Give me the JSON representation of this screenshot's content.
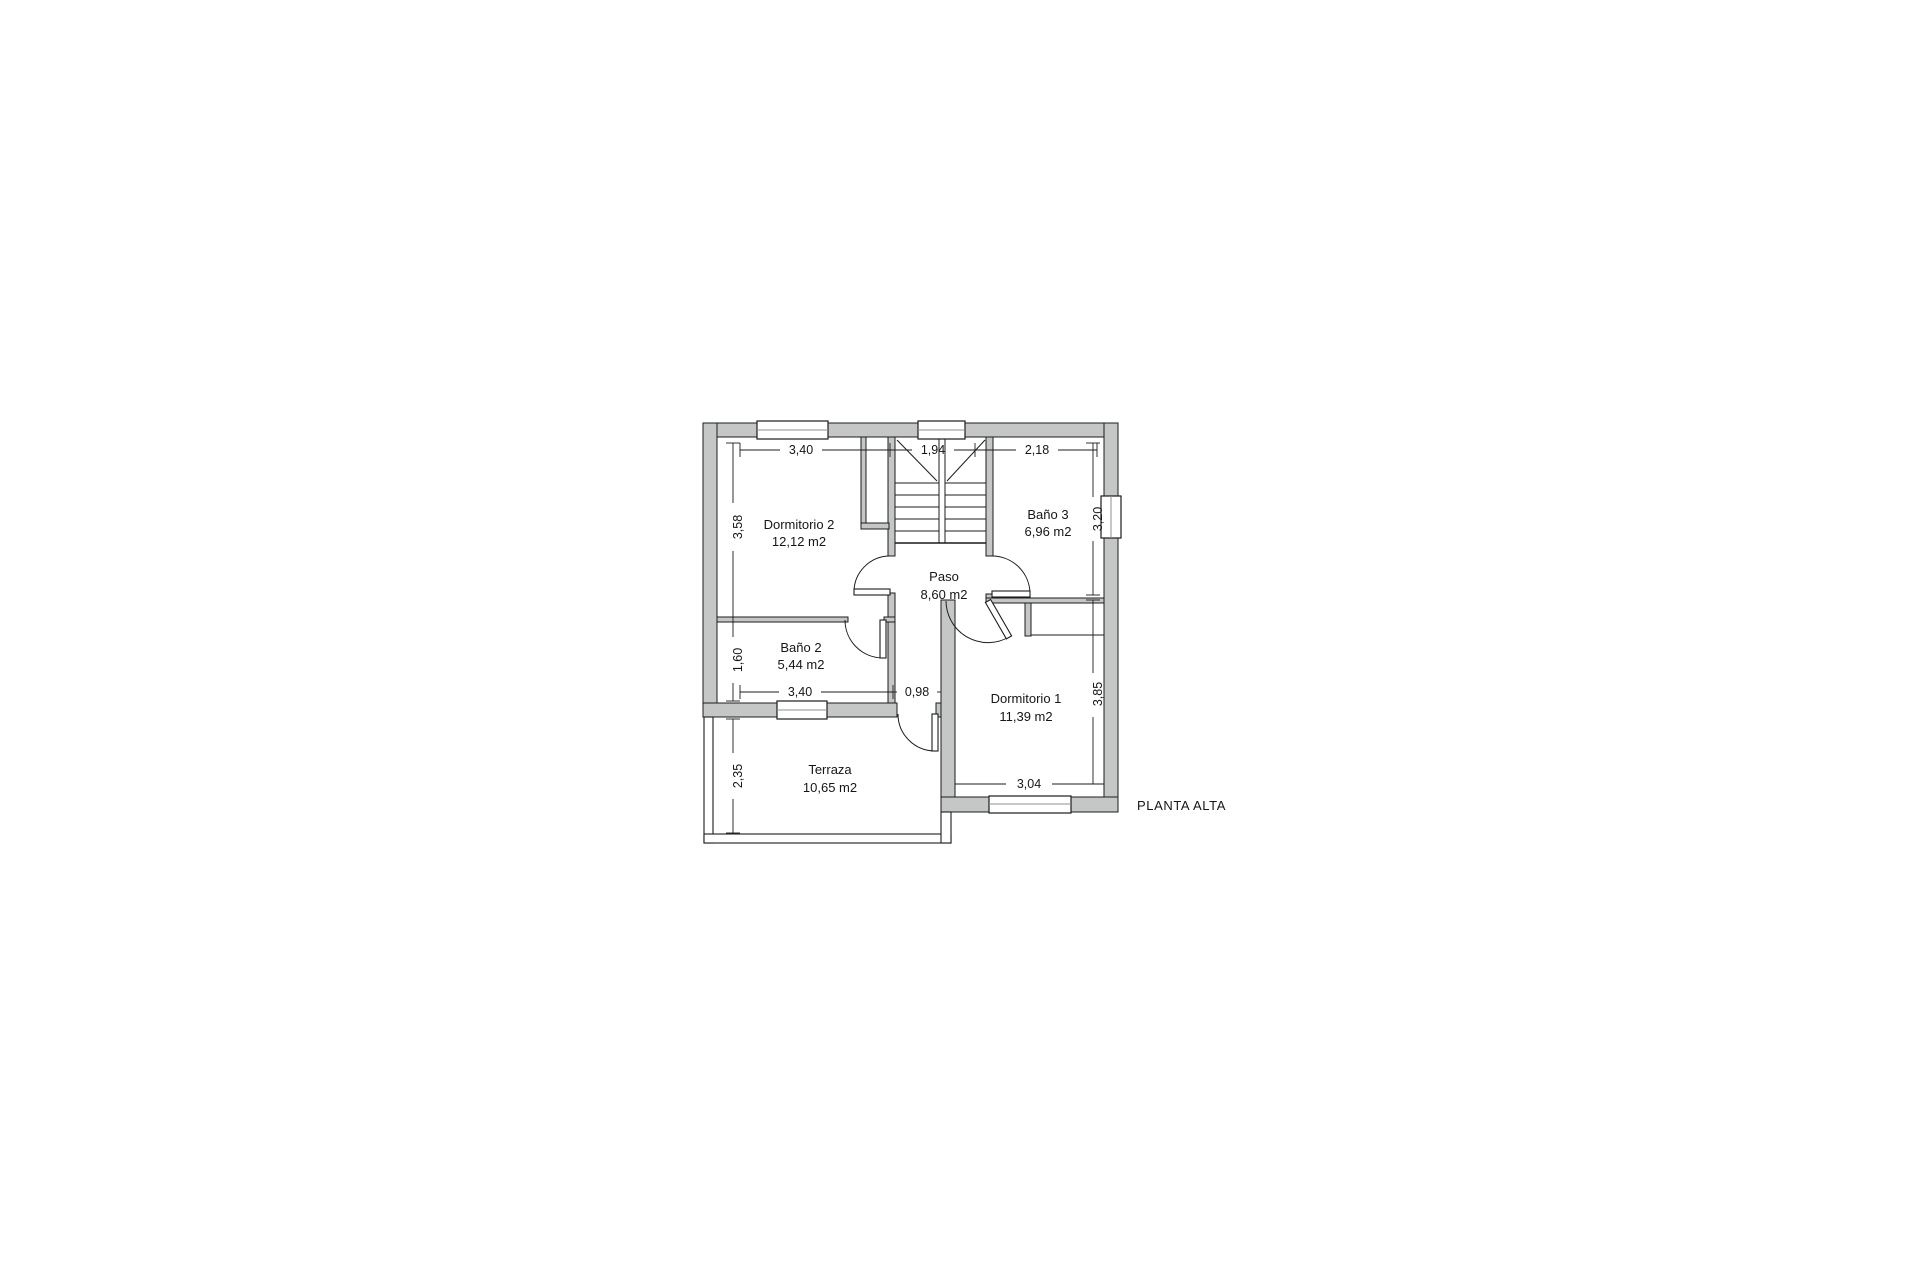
{
  "title": "PLANTA ALTA",
  "rooms": {
    "dormitorio2": {
      "name": "Dormitorio 2",
      "area": "12,12 m2"
    },
    "bano3": {
      "name": "Baño 3",
      "area": "6,96 m2"
    },
    "paso": {
      "name": "Paso",
      "area": "8,60 m2"
    },
    "bano2": {
      "name": "Baño 2",
      "area": "5,44 m2"
    },
    "dormitorio1": {
      "name": "Dormitorio 1",
      "area": "11,39 m2"
    },
    "terraza": {
      "name": "Terraza",
      "area": "10,65 m2"
    }
  },
  "dims": {
    "dorm2_width": "3,40",
    "stairs_width": "1,94",
    "bano3_width": "2,18",
    "dorm2_height": "3,58",
    "bano2_height": "1,60",
    "terraza_height": "2,35",
    "bano2_width": "3,40",
    "terraza_door_width": "0,98",
    "dorm1_width": "3,04",
    "bano3_height": "3,20",
    "dorm1_height": "3,85"
  },
  "colors": {
    "wall_fill": "#c5c7c7",
    "line": "#1c1c1c",
    "background": "#ffffff"
  }
}
